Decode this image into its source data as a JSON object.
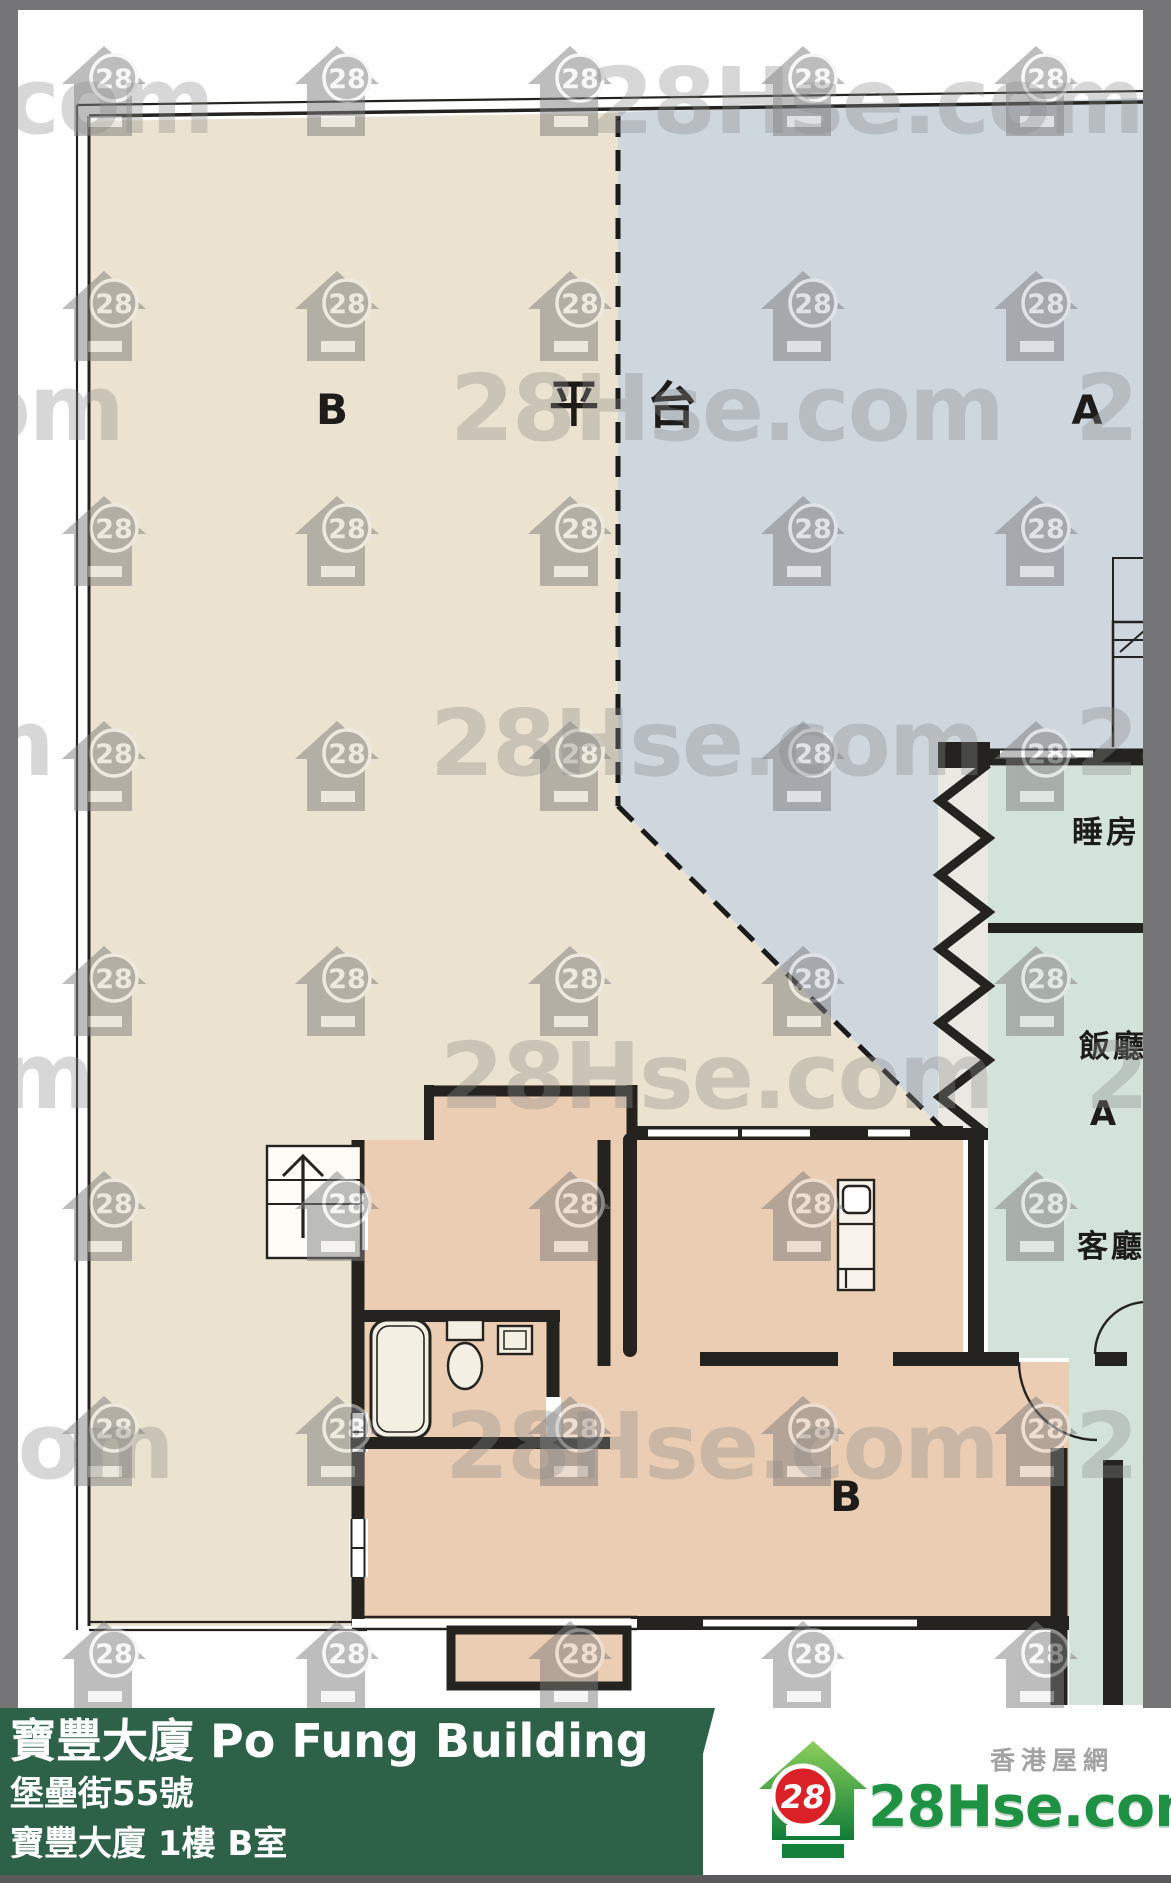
{
  "watermark": {
    "brand": "28Hse.com",
    "badge": "28"
  },
  "plan": {
    "terrace_b": "B",
    "platform_1": "平",
    "platform_2": "台",
    "terrace_a": "A",
    "bedroom": "睡房",
    "dining": "飯廳",
    "dining_unit": "A",
    "living": "客廳",
    "room_b": "B"
  },
  "info_bar": {
    "title": "寶豐大廈 Po Fung Building",
    "address": "堡壘街55號",
    "unit": "寶豐大廈 1樓 B室",
    "bar_color": "#2d6249"
  },
  "brand_footer": {
    "tagline": "香港屋網",
    "site": "28Hse.com",
    "badge": "28",
    "logo_green": "#1f9143",
    "logo_red": "#da2128"
  }
}
